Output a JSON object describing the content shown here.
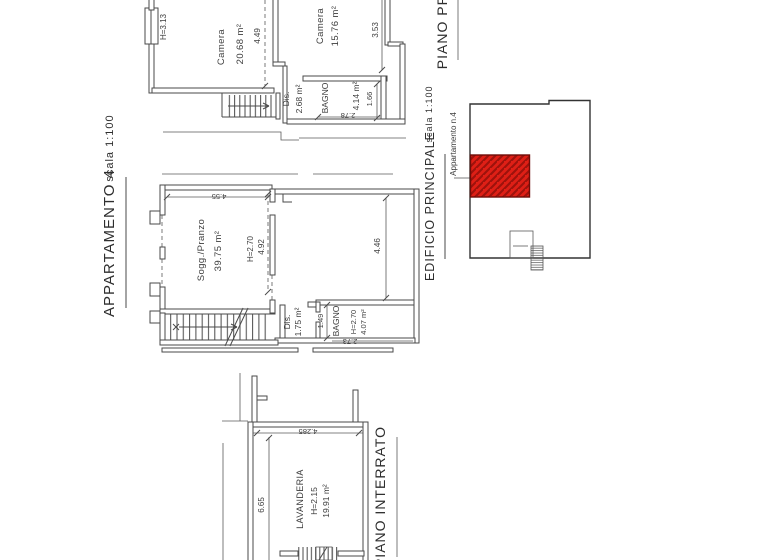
{
  "drawing": {
    "title": "APPARTAMENTO 4",
    "title_scale": "scala 1:100",
    "sections": {
      "piano_primo": "PIANO PRIMO",
      "piano_interrato": "PIANO INTERRATO"
    },
    "key_plan": {
      "title": "EDIFICIO PRINCIPALE",
      "scale": "scala 1:100",
      "callout": "Appartamento n.4",
      "highlight_color": "#df1f16"
    },
    "plans": {
      "primo": {
        "camera1": {
          "name": "Camera",
          "area": "20.68 m²"
        },
        "camera2": {
          "name": "Camera",
          "area": "15.76 m²"
        },
        "bagno": {
          "name": "BAGNO",
          "area": "4.14 m²"
        },
        "dis": {
          "name": "Dis.",
          "area": "2.68 m²"
        },
        "window_height": "H=3.13",
        "dims": {
          "d449": "4.49",
          "d353": "3.53",
          "d166": "1.66",
          "d278": "2.78"
        }
      },
      "middle": {
        "sogg": {
          "name": "Sogg./Pranzo",
          "area": "39.75 m²",
          "height": "H=2.70"
        },
        "bagno": {
          "name": "BAGNO",
          "height": "H=2.70",
          "area": "4.07 m²"
        },
        "dis": {
          "name": "Dis.",
          "area": "1.75 m²"
        },
        "dims": {
          "d455": "4.55",
          "d492": "4.92",
          "d446": "4.46",
          "d149": "1.49",
          "d273": "2.73"
        }
      },
      "interrato": {
        "lavanderia": {
          "name": "LAVANDERIA",
          "height": "H=2.15",
          "area": "19.91 m²"
        },
        "dims": {
          "d665": "6.65",
          "d4285": "4.285"
        }
      }
    }
  }
}
